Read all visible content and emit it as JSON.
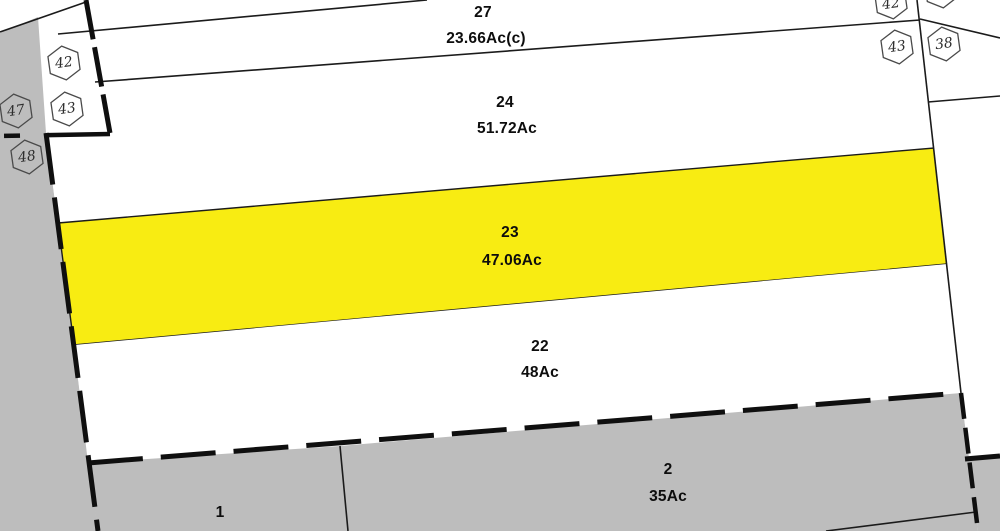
{
  "map": {
    "colors": {
      "highlight": "#F8EC12",
      "adjacent": "#BDBDBD",
      "parcel": "#FFFFFF",
      "line": "#1B1B1B"
    },
    "parcels": [
      {
        "number": "27",
        "acreage": "23.66Ac(c)"
      },
      {
        "number": "24",
        "acreage": "51.72Ac"
      },
      {
        "number": "23",
        "acreage": "47.06Ac"
      },
      {
        "number": "22",
        "acreage": "48Ac"
      },
      {
        "number": "2",
        "acreage": "35Ac"
      },
      {
        "number": "1",
        "acreage": ""
      }
    ],
    "badges": [
      "42",
      "43",
      "47",
      "48",
      "42",
      "43",
      "38",
      ""
    ]
  }
}
